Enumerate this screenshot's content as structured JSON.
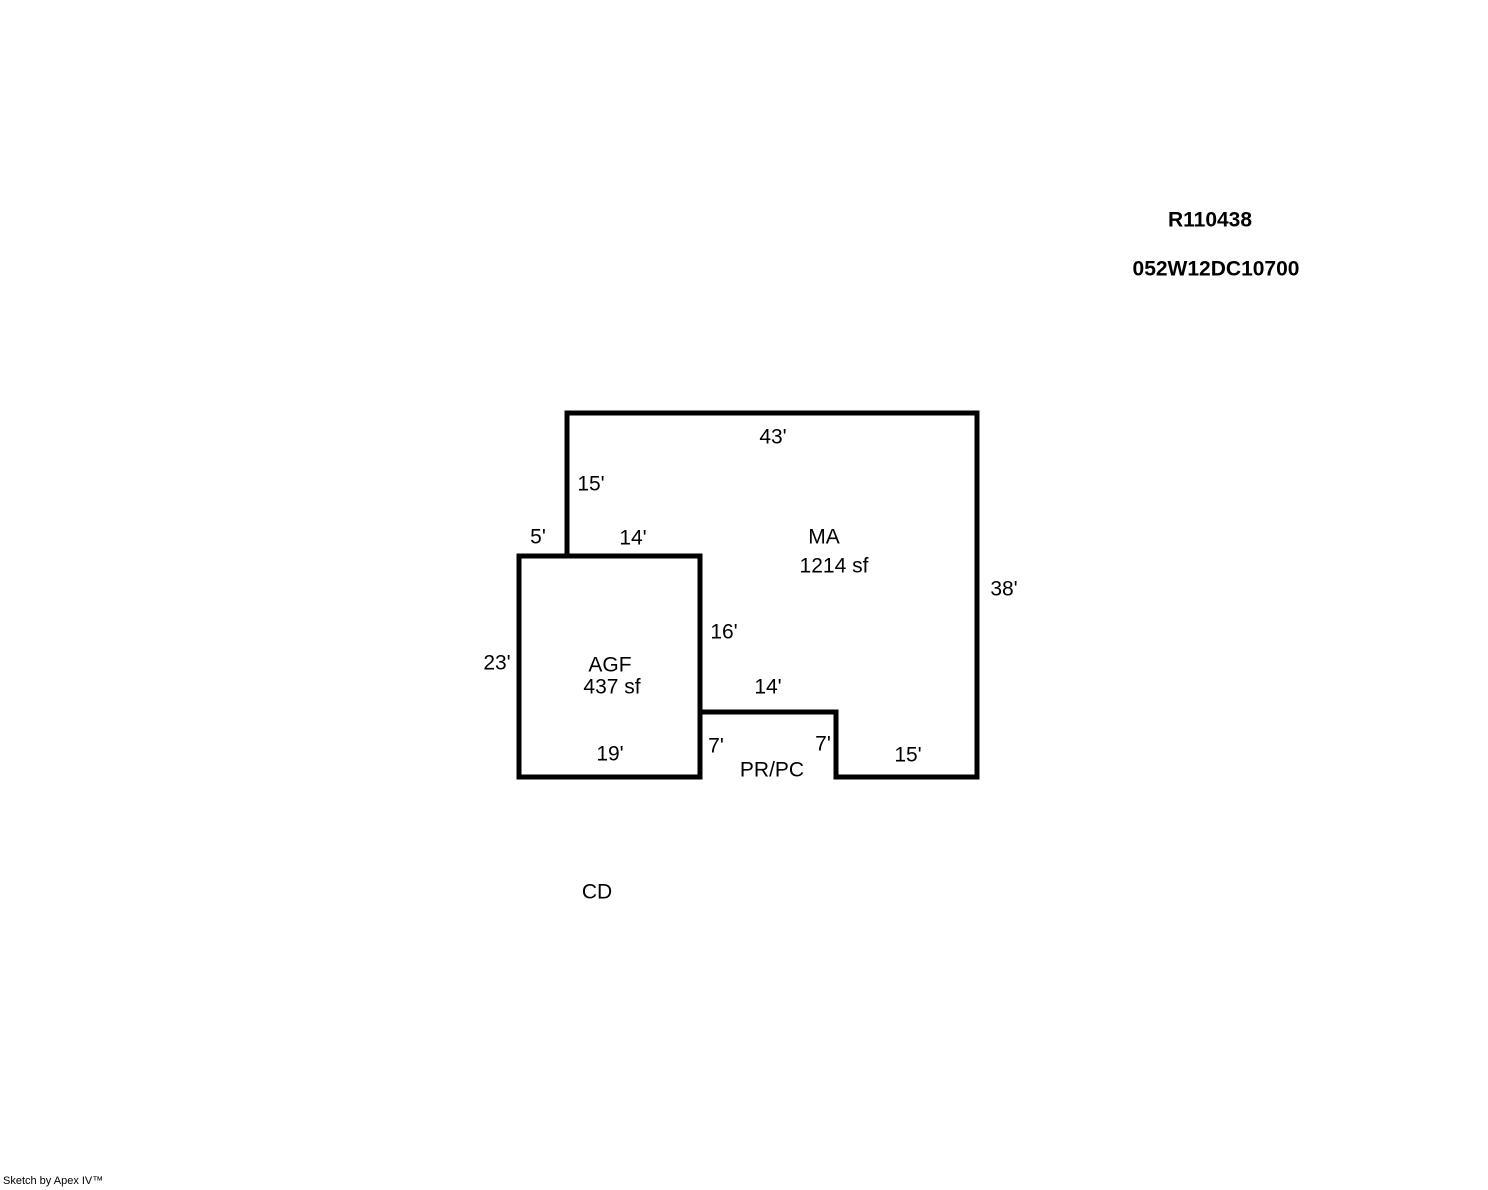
{
  "header": {
    "record_id": "R110438",
    "parcel_id": "052W12DC10700"
  },
  "sketch": {
    "areas": {
      "ma": {
        "label": "MA",
        "size": "1214 sf"
      },
      "agf": {
        "label": "AGF",
        "size": "437 sf"
      },
      "prpc": {
        "label": "PR/PC"
      }
    },
    "dimensions": {
      "top": "43'",
      "left_upper": "15'",
      "jog": "5'",
      "agf_top": "14'",
      "right": "38'",
      "agf_right": "16'",
      "agf_left": "23'",
      "notch_top": "14'",
      "notch_left": "7'",
      "notch_right": "7'",
      "agf_bottom": "19'",
      "bottom_right": "15'"
    },
    "detached_label": "CD",
    "line_color": "#000000"
  },
  "footer": {
    "credit": "Sketch by Apex IV™"
  }
}
